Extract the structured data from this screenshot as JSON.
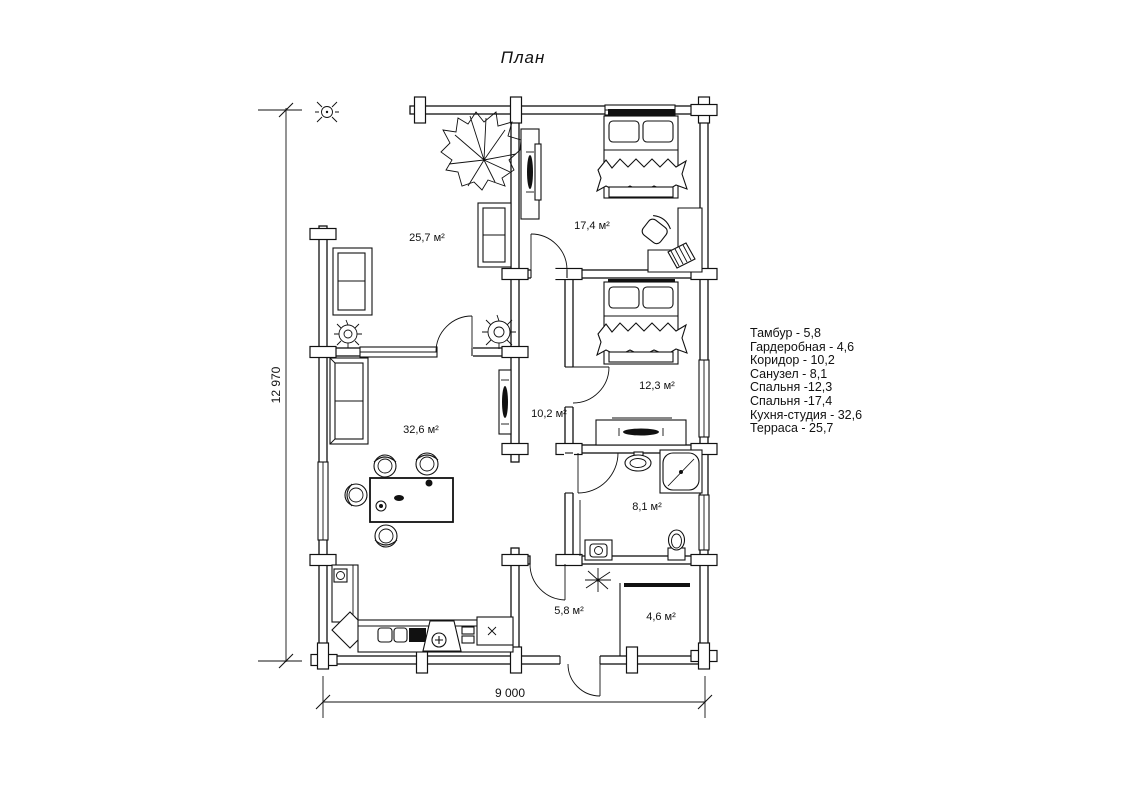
{
  "title": "План",
  "dimensions": {
    "vertical": "12 970",
    "horizontal": "9 000"
  },
  "rooms": [
    {
      "name": "Терраса",
      "label": "25,7 м²"
    },
    {
      "name": "Спальня",
      "label": "17,4 м²"
    },
    {
      "name": "Спальня",
      "label": "12,3 м²"
    },
    {
      "name": "Коридор",
      "label": "10,2 м²"
    },
    {
      "name": "Кухня-студия",
      "label": "32,6 м²"
    },
    {
      "name": "Санузел",
      "label": "8,1 м²"
    },
    {
      "name": "Тамбур",
      "label": "5,8 м²"
    },
    {
      "name": "Гардеробная",
      "label": "4,6 м²"
    }
  ],
  "legend": {
    "items": [
      "Тамбур - 5,8",
      "Гардеробная - 4,6",
      "Коридор - 10,2",
      "Санузел - 8,1",
      "Спальня -12,3",
      "Спальня -17,4",
      "Кухня-студия - 32,6",
      "Терраса - 25,7"
    ]
  },
  "counter_marks": {
    "stove_plus": "+",
    "module_x": "x"
  },
  "colors": {
    "ink": "#111111",
    "paper": "#ffffff"
  }
}
